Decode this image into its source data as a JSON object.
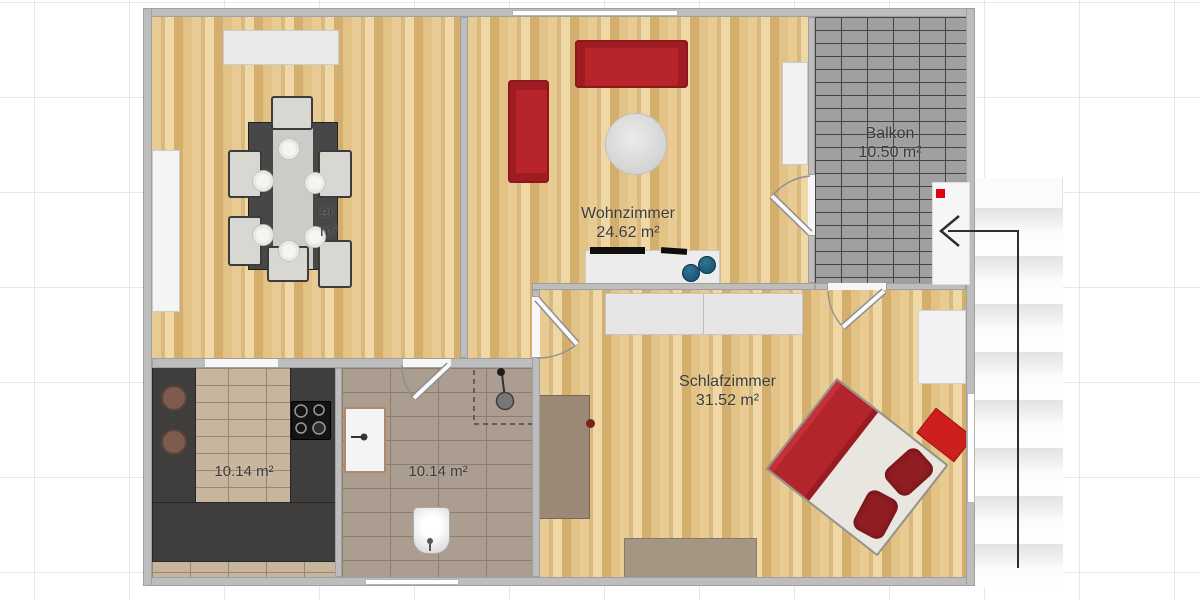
{
  "plan_type": "apartment-floor-plan",
  "rooms": {
    "dining": {
      "visible_name_fragment": "er",
      "visible_area_fragment": "m²"
    },
    "living": {
      "name": "Wohnzimmer",
      "area": "24.62 m²"
    },
    "balcony": {
      "name": "Balkon",
      "area": "10.50 m²"
    },
    "bedroom": {
      "name": "Schlafzimmer",
      "area": "31.52 m²"
    },
    "kitchen": {
      "area": "10.14 m²"
    },
    "bathroom": {
      "area": "10.14 m²"
    }
  },
  "colors": {
    "wood_floor": "#e2c186",
    "balcony_tile": "#a0a0a0",
    "kitchen_tile": "#c7b59e",
    "bath_tile": "#ab9d90",
    "wall_gray": "#bdbdbd",
    "sofa_red": "#b7242a",
    "bed_red": "#b3252b",
    "entrance_marker_red": "#e3000f",
    "counter_dark": "#3f3e3c",
    "label_text": "#3c3c3c"
  },
  "markers": {
    "entrance_arrow": "points-left-into-door-then-down-stairs",
    "entrance_door_marker": "red-square"
  }
}
